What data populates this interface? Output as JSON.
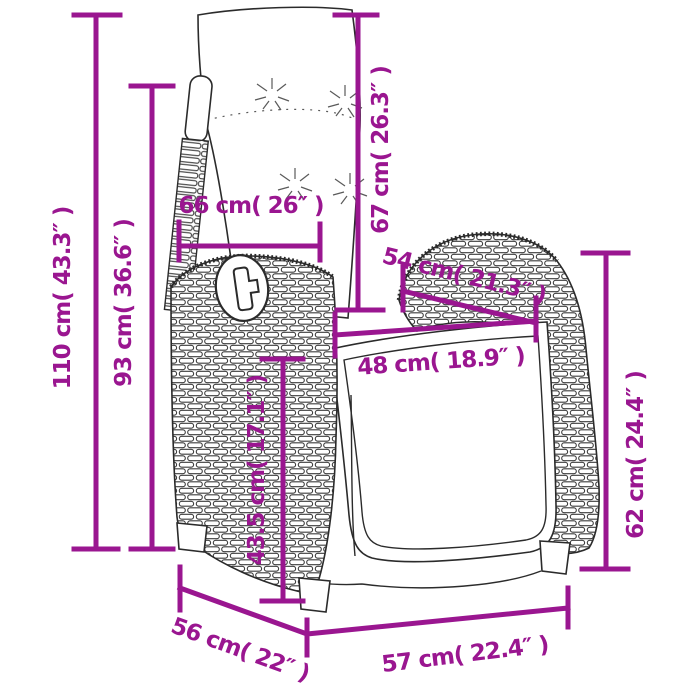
{
  "diagram": {
    "title": "reclining garden chair with cushions - dimension drawing",
    "accent_color": "#9A1690",
    "outline_color": "#2B2B2B",
    "unit_primary": "cm",
    "unit_secondary": "inch",
    "dimensions": {
      "total_height": {
        "label": "110 cm( 43.3″ )",
        "cm": "110",
        "inch": "43.3"
      },
      "backrest_height": {
        "label": "93 cm( 36.6″ )",
        "cm": "93",
        "inch": "36.6"
      },
      "back_cushion_width": {
        "label": "66 cm( 26″ )",
        "cm": "66",
        "inch": "26"
      },
      "back_cushion_height": {
        "label": "67 cm( 26.3″ )",
        "cm": "67",
        "inch": "26.3"
      },
      "armrest_depth": {
        "label": "54 cm( 21.3″ )",
        "cm": "54",
        "inch": "21.3"
      },
      "seat_width": {
        "label": "48 cm( 18.9″ )",
        "cm": "48",
        "inch": "18.9"
      },
      "seat_height": {
        "label": "43.5 cm( 17.1″ )",
        "cm": "43.5",
        "inch": "17.1"
      },
      "armrest_height": {
        "label": "62 cm( 24.4″ )",
        "cm": "62",
        "inch": "24.4"
      },
      "base_depth": {
        "label": "56 cm( 22″ )",
        "cm": "56",
        "inch": "22"
      },
      "base_width": {
        "label": "57 cm( 22.4″ )",
        "cm": "57",
        "inch": "22.4"
      }
    }
  }
}
